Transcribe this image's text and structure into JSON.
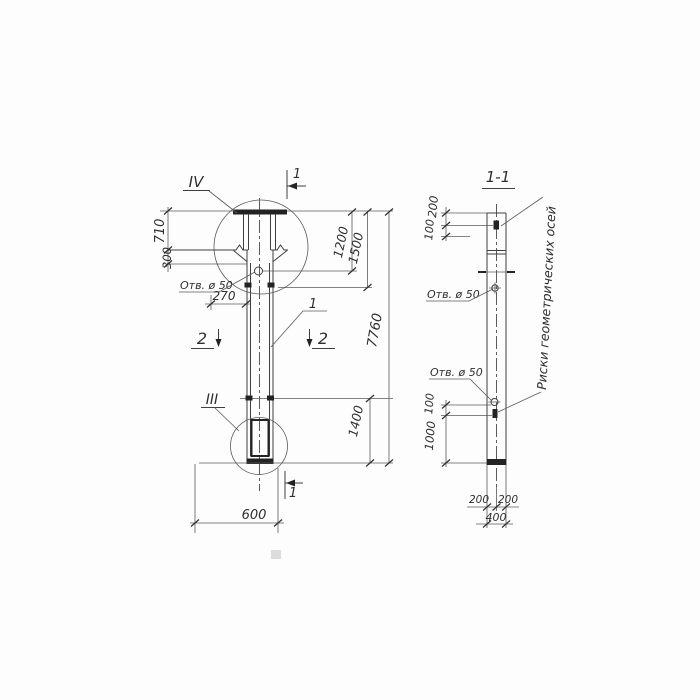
{
  "palette": {
    "ink": "#3a3a3a",
    "paper": "#fdfdfd"
  },
  "front_view": {
    "detail_marker_top": "IV",
    "detail_marker_bottom": "III",
    "section_mark_top": "1",
    "section_mark_bottom": "1",
    "section_mark_left": "2",
    "section_mark_right": "2",
    "part_label": "1",
    "hole_label": "Отв. ø 50",
    "dims": {
      "left_upper": "710",
      "left_lower": "300",
      "hole_offset": "270",
      "width": "600",
      "right_inner": "1200",
      "right_mid": "1500",
      "total_height": "7760",
      "bottom_segment": "1400"
    }
  },
  "section_view": {
    "title": "1-1",
    "hole_label_upper": "Отв. ø 50",
    "hole_label_lower": "Отв. ø 50",
    "axes_note": "Риски геометрических осей",
    "dims": {
      "top_a": "200",
      "top_b": "100",
      "bottom_a": "100",
      "bottom_b": "1000",
      "half_left": "200",
      "half_right": "200",
      "width": "400"
    }
  }
}
